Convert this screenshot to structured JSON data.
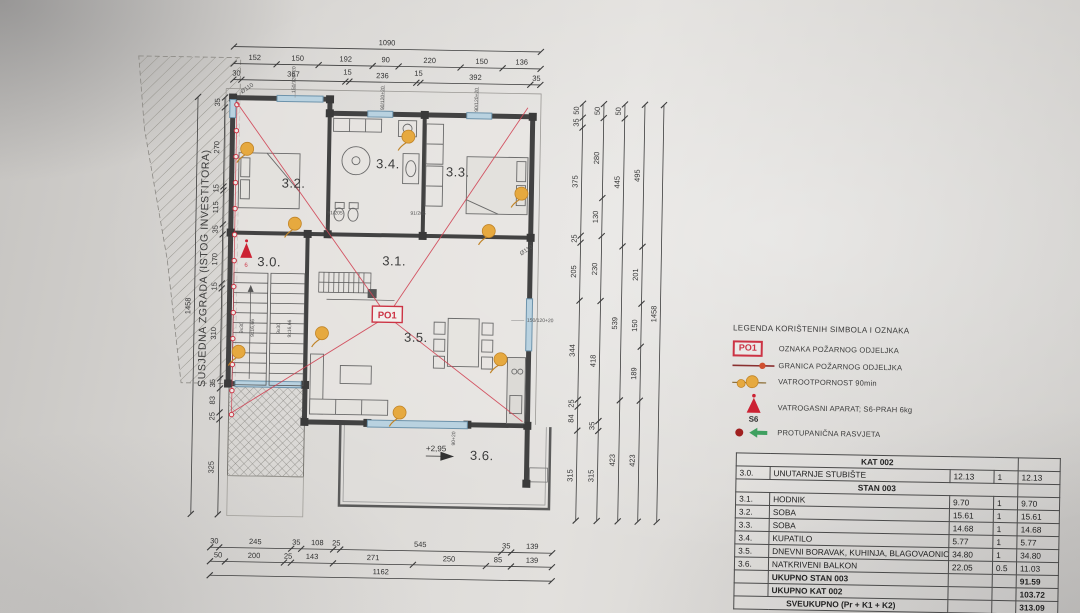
{
  "plan": {
    "rooms": {
      "r30": "3.0.",
      "r31": "3.1.",
      "r32": "3.2.",
      "r33": "3.3.",
      "r34": "3.4.",
      "r35": "3.5.",
      "r36": "3.6."
    },
    "po1": "PO1",
    "s6_mark": "6",
    "elevation": "+2,95",
    "side_text": "SUSJEDNA ZGRADA (ISTOG INVESTITORA)",
    "stairs": {
      "a": "9x30",
      "b": "9x16,66"
    },
    "door_label": "91/205",
    "win_top_label": "90/120+20",
    "win_left_label": "150/120+20",
    "win_right_label": "150/120+20",
    "drain_label": "Ø110",
    "balcony_door_label": "90+20"
  },
  "dims": {
    "t1": [
      "1090"
    ],
    "t2": [
      "152",
      "150",
      "192",
      "90",
      "220",
      "150",
      "136"
    ],
    "t3": [
      "30",
      "367",
      "15",
      "236",
      "15",
      "392",
      "35"
    ],
    "b1": [
      "30",
      "245",
      "35",
      "108",
      "25",
      "545",
      "35",
      "139"
    ],
    "b2": [
      "50",
      "200",
      "25",
      "143",
      "271",
      "250",
      "85",
      "139"
    ],
    "b3": [
      "1162"
    ],
    "l1": [
      "35",
      "270",
      "15",
      "115",
      "35",
      "170",
      "15",
      "310",
      "35",
      "83",
      "25",
      "325"
    ],
    "l2": [
      "1458"
    ],
    "r1": [
      "50",
      "35",
      "375",
      "25",
      "205",
      "344",
      "25",
      "84",
      "315"
    ],
    "r2": [
      "50",
      "280",
      "130",
      "230",
      "418",
      "35",
      "315"
    ],
    "r3": [
      "50",
      "445",
      "539",
      "423"
    ],
    "r4": [
      "495",
      "201",
      "150",
      "189",
      "423"
    ],
    "r5": [
      "1458"
    ]
  },
  "legend": {
    "title": "LEGENDA KORIŠTENIH SIMBOLA I OZNAKA",
    "po1_symbol": "PO1",
    "s6_symbol": "S6",
    "items": [
      "OZNAKA POŽARNOG ODJELJKA",
      "GRANICA POŽARNOG ODJELJKA",
      "VATROOTPORNOST 90min",
      "VATROGASNI APARAT; S6-PRAH 6kg",
      "PROTUPANIČNA RASVJETA"
    ]
  },
  "table": {
    "kat_header": "KAT 002",
    "stan_header": "STAN 003",
    "rows_kat": [
      {
        "id": "3.0.",
        "name": "UNUTARNJE STUBIŠTE",
        "area": "12.13",
        "coef": "1",
        "total": "12.13"
      }
    ],
    "rows_stan": [
      {
        "id": "3.1.",
        "name": "HODNIK",
        "area": "9.70",
        "coef": "1",
        "total": "9.70"
      },
      {
        "id": "3.2.",
        "name": "SOBA",
        "area": "15.61",
        "coef": "1",
        "total": "15.61"
      },
      {
        "id": "3.3.",
        "name": "SOBA",
        "area": "14.68",
        "coef": "1",
        "total": "14.68"
      },
      {
        "id": "3.4.",
        "name": "KUPATILO",
        "area": "5.77",
        "coef": "1",
        "total": "5.77"
      },
      {
        "id": "3.5.",
        "name": "DNEVNI BORAVAK, KUHINJA, BLAGOVAONICA",
        "area": "34.80",
        "coef": "1",
        "total": "34.80"
      },
      {
        "id": "3.6.",
        "name": "NATKRIVENI BALKON",
        "area": "22.05",
        "coef": "0.5",
        "total": "11.03"
      }
    ],
    "ukupno_stan": {
      "label": "UKUPNO STAN 003",
      "value": "91.59"
    },
    "ukupno_kat": {
      "label": "UKUPNO KAT 002",
      "value": "103.72"
    },
    "sveukupno": {
      "label": "SVEUKUPNO (Pr + K1 + K2)",
      "value": "313.09"
    }
  }
}
